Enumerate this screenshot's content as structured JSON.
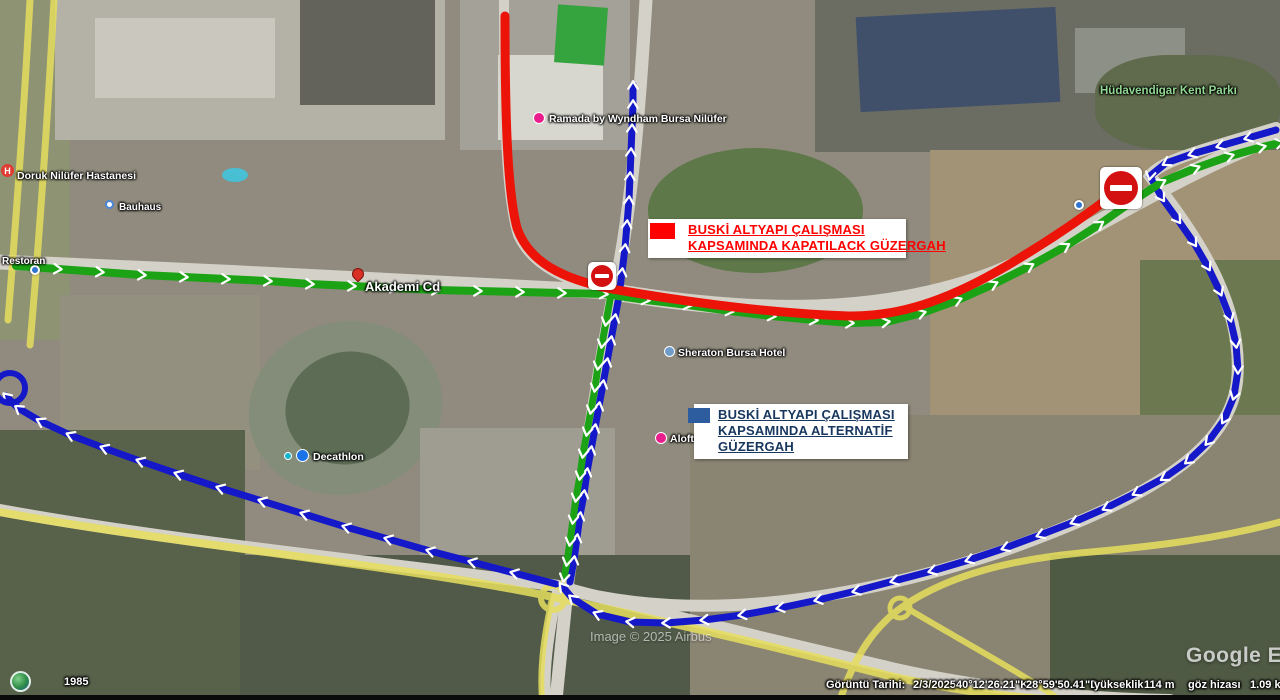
{
  "map": {
    "watermark": "Google Ea",
    "imagery_credit": "Image © 2025 Airbus",
    "history_year": "1985"
  },
  "status_bar": {
    "date_label": "Görüntü Tarihi:",
    "date_value": "2/3/2025",
    "latitude": "40°12'26.21\"K",
    "longitude": "28°59'50.41\"D",
    "altitude_label": "yükseklik",
    "altitude_value": "114 m",
    "eye_alt_label": "göz hizası",
    "eye_alt_value": "1.09 k"
  },
  "legend": {
    "closed_route": {
      "line1": "BUSKİ ALTYAPI ÇALIŞMASI",
      "line2": "KAPSAMINDA KAPATILACK GÜZERGAH",
      "swatch_color": "#ff0000",
      "text_color": "#ff0000"
    },
    "alternative_route": {
      "line1": "BUSKİ ALTYAPI ÇALIŞMASI",
      "line2": "KAPSAMINDA ALTERNATİF",
      "line3": "GÜZERGAH",
      "swatch_color": "#2e5d9f",
      "text_color": "#17375e"
    }
  },
  "places": {
    "hospital": "Doruk Nilüfer Hastanesi",
    "hospital_icon_letter": "H",
    "bauhaus": "Bauhaus",
    "restoran": "Restoran",
    "akademi_cd": "Akademi Cd",
    "ramada": "Ramada by Wyndham Bursa Nilüfer",
    "sheraton": "Sheraton Bursa Hotel",
    "aloft": "Aloft Bu",
    "kent_park": "Hüdavendigar Kent Parkı",
    "decathlon": "Decathlon"
  },
  "routes": {
    "closed_color": "#ec1408",
    "open_color": "#1ba315",
    "alternative_color": "#1418c9",
    "road_highlight_color": "#e6df5e"
  }
}
